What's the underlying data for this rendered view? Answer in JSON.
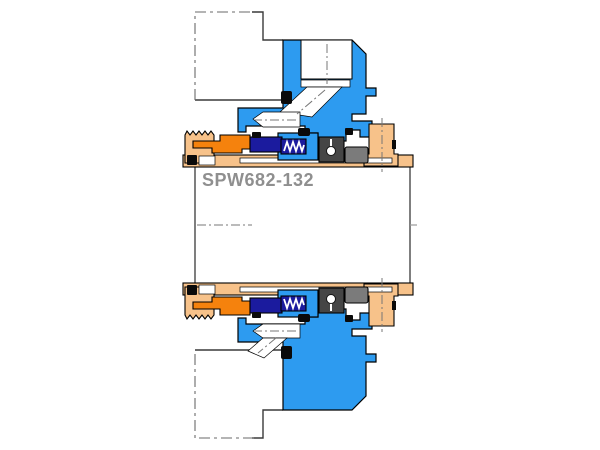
{
  "diagram": {
    "label": "SPW682-132",
    "description": "Mechanical seal cartridge cross-section drawing",
    "colors": {
      "gland_blue": "#2D9BF0",
      "sleeve_peach": "#F7C28A",
      "seal_orange": "#F5820D",
      "seal_navy": "#1B1B9E",
      "screw_dark_gray": "#454545",
      "collar_gray": "#7B7B7B",
      "outline_black": "#0a0a0a",
      "equipment_line_gray": "#3a3a3a",
      "centerline_gray": "#777777",
      "label_gray": "#8F8F8F"
    }
  }
}
